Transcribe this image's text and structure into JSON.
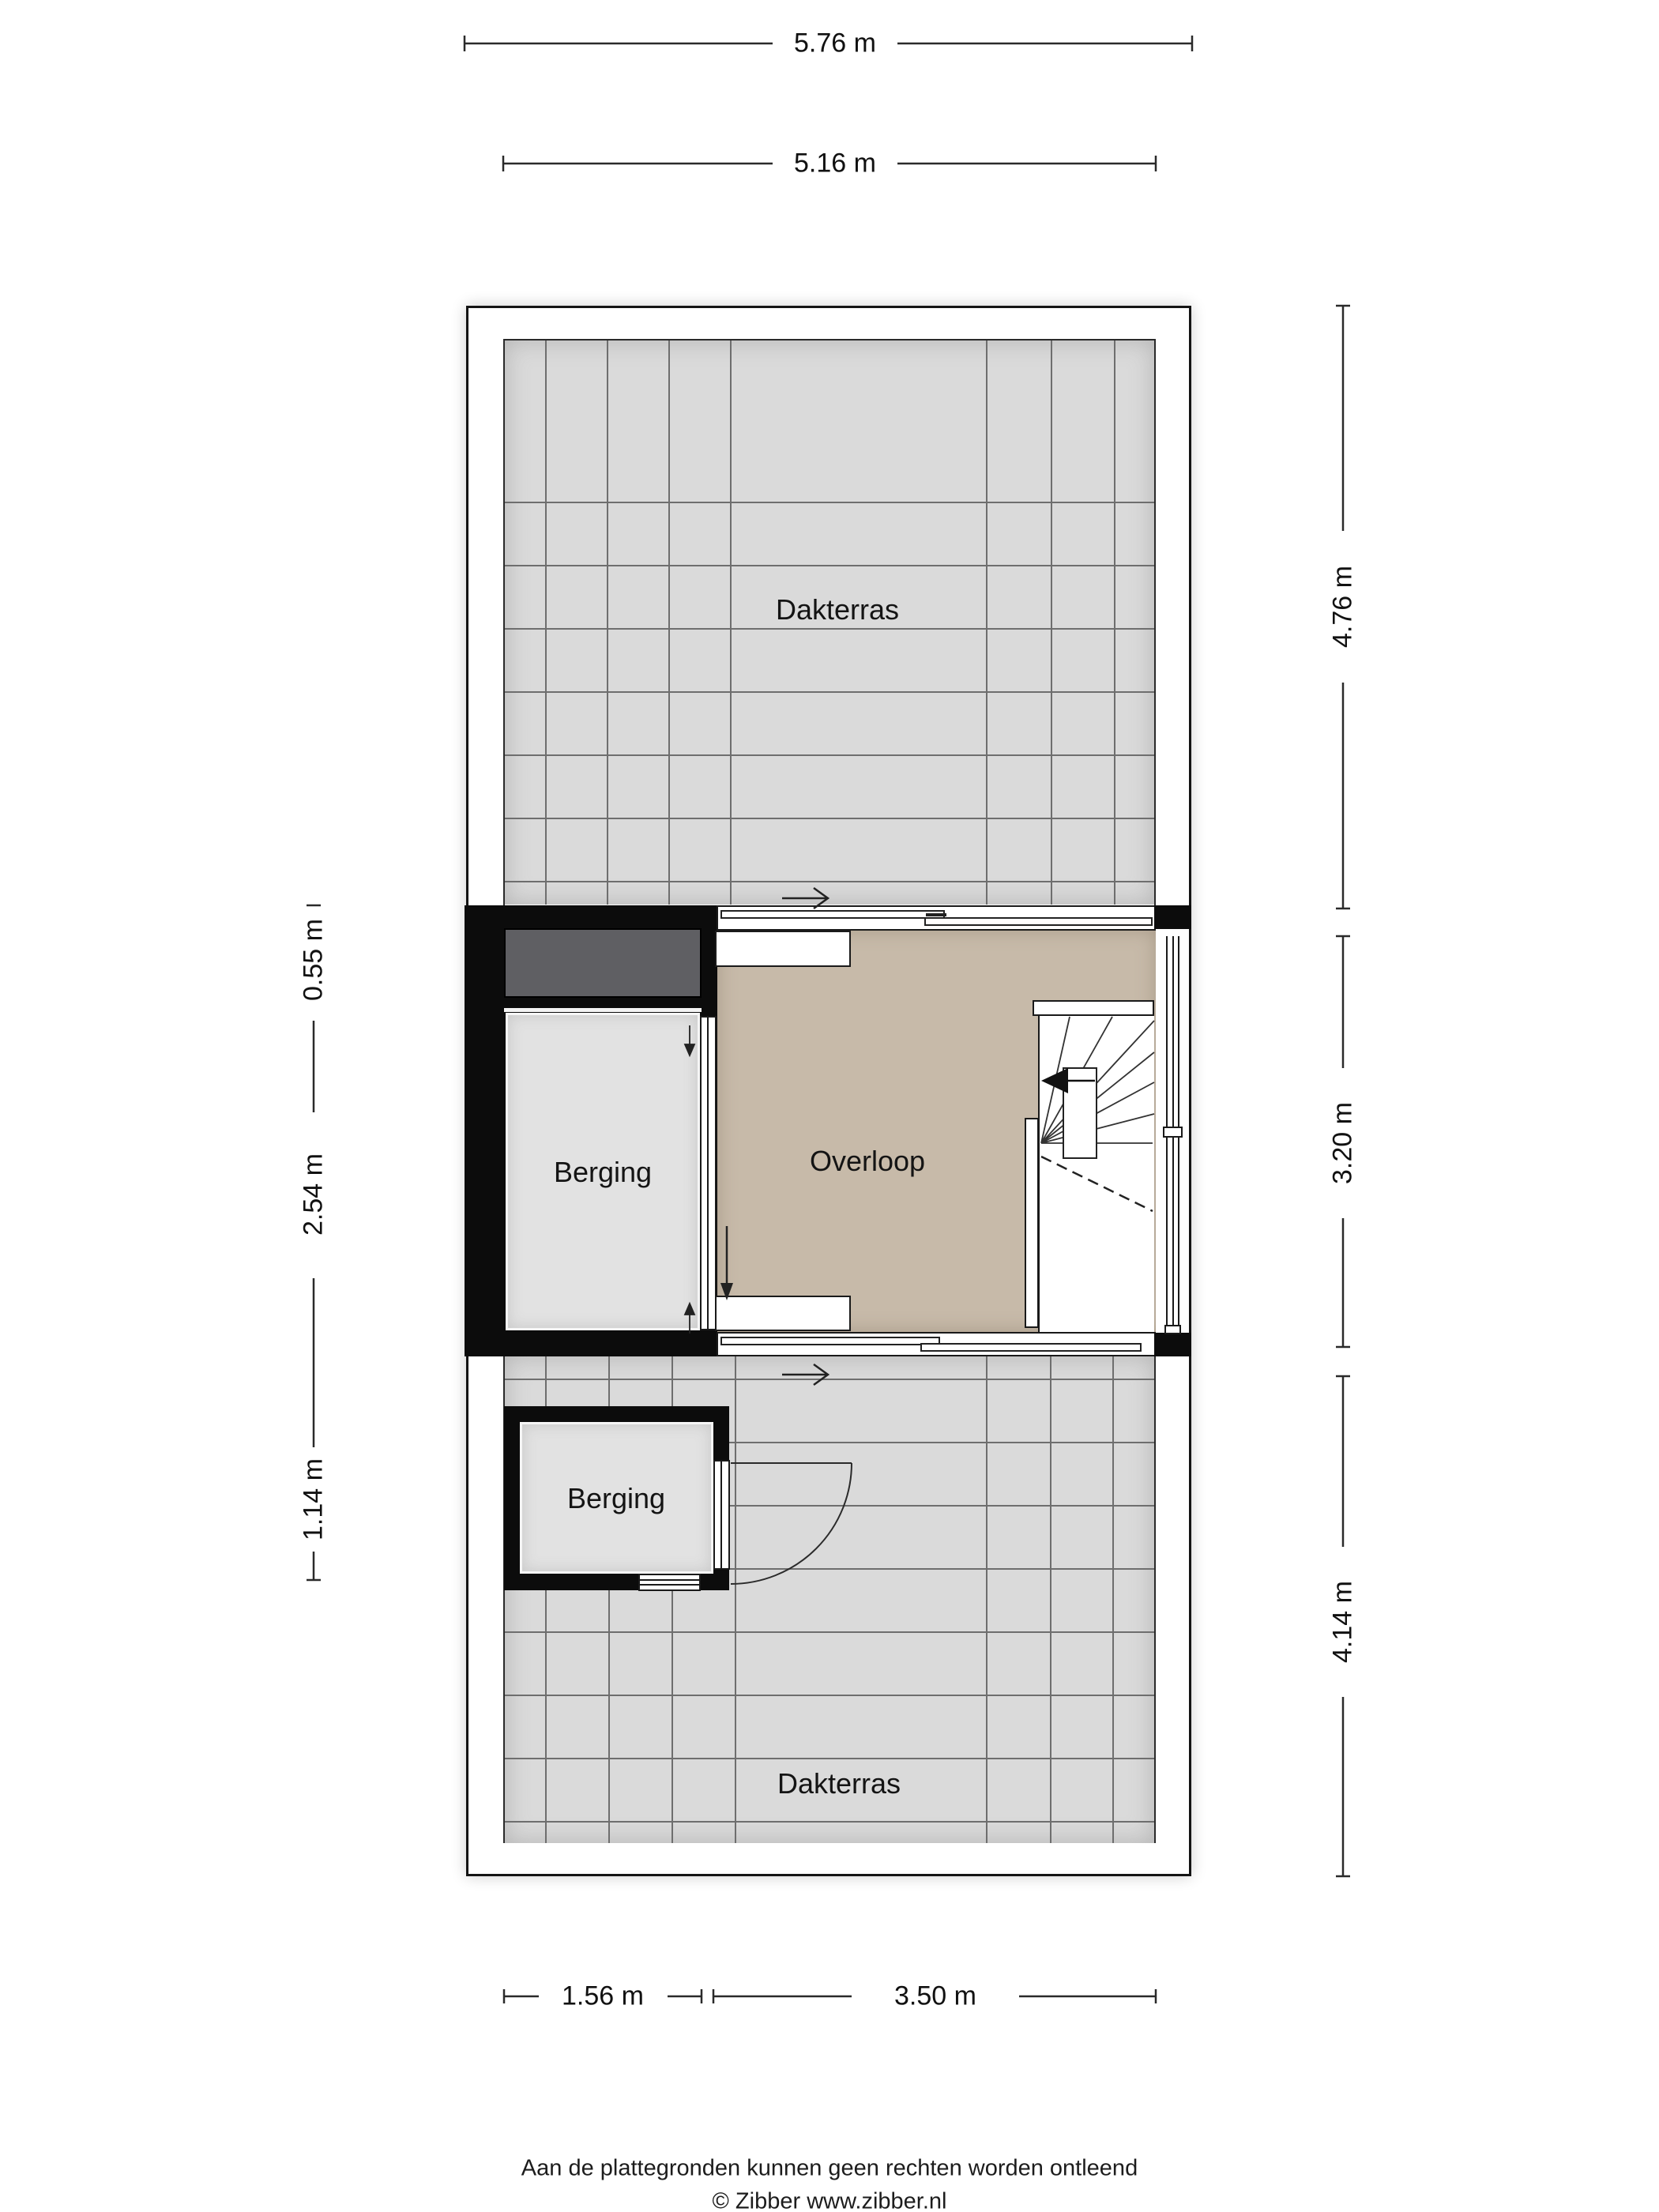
{
  "plan": {
    "rooms": {
      "dakterras_top": "Dakterras",
      "berging_upper": "Berging",
      "overloop": "Overloop",
      "berging_lower": "Berging",
      "dakterras_bottom": "Dakterras"
    },
    "dimensions": {
      "width_outer": "5.76 m",
      "width_inner": "5.16 m",
      "right_top": "4.76 m",
      "right_middle": "3.20 m",
      "right_bottom": "4.14 m",
      "left_top": "0.55 m",
      "left_middle": "2.54 m",
      "left_bottom": "1.14 m",
      "bottom_left": "1.56 m",
      "bottom_right": "3.50 m"
    },
    "colors": {
      "wall_black": "#0c0c0c",
      "tile_gray": "#dadada",
      "floor_beige": "#c7baa9",
      "room_gray": "#e2e2e2",
      "skylight_dark_gray": "#5f5f63",
      "line_dark": "#1a1a1a"
    }
  },
  "footer": {
    "disclaimer": "Aan de plattegronden kunnen geen rechten worden ontleend",
    "credit": "© Zibber www.zibber.nl"
  }
}
